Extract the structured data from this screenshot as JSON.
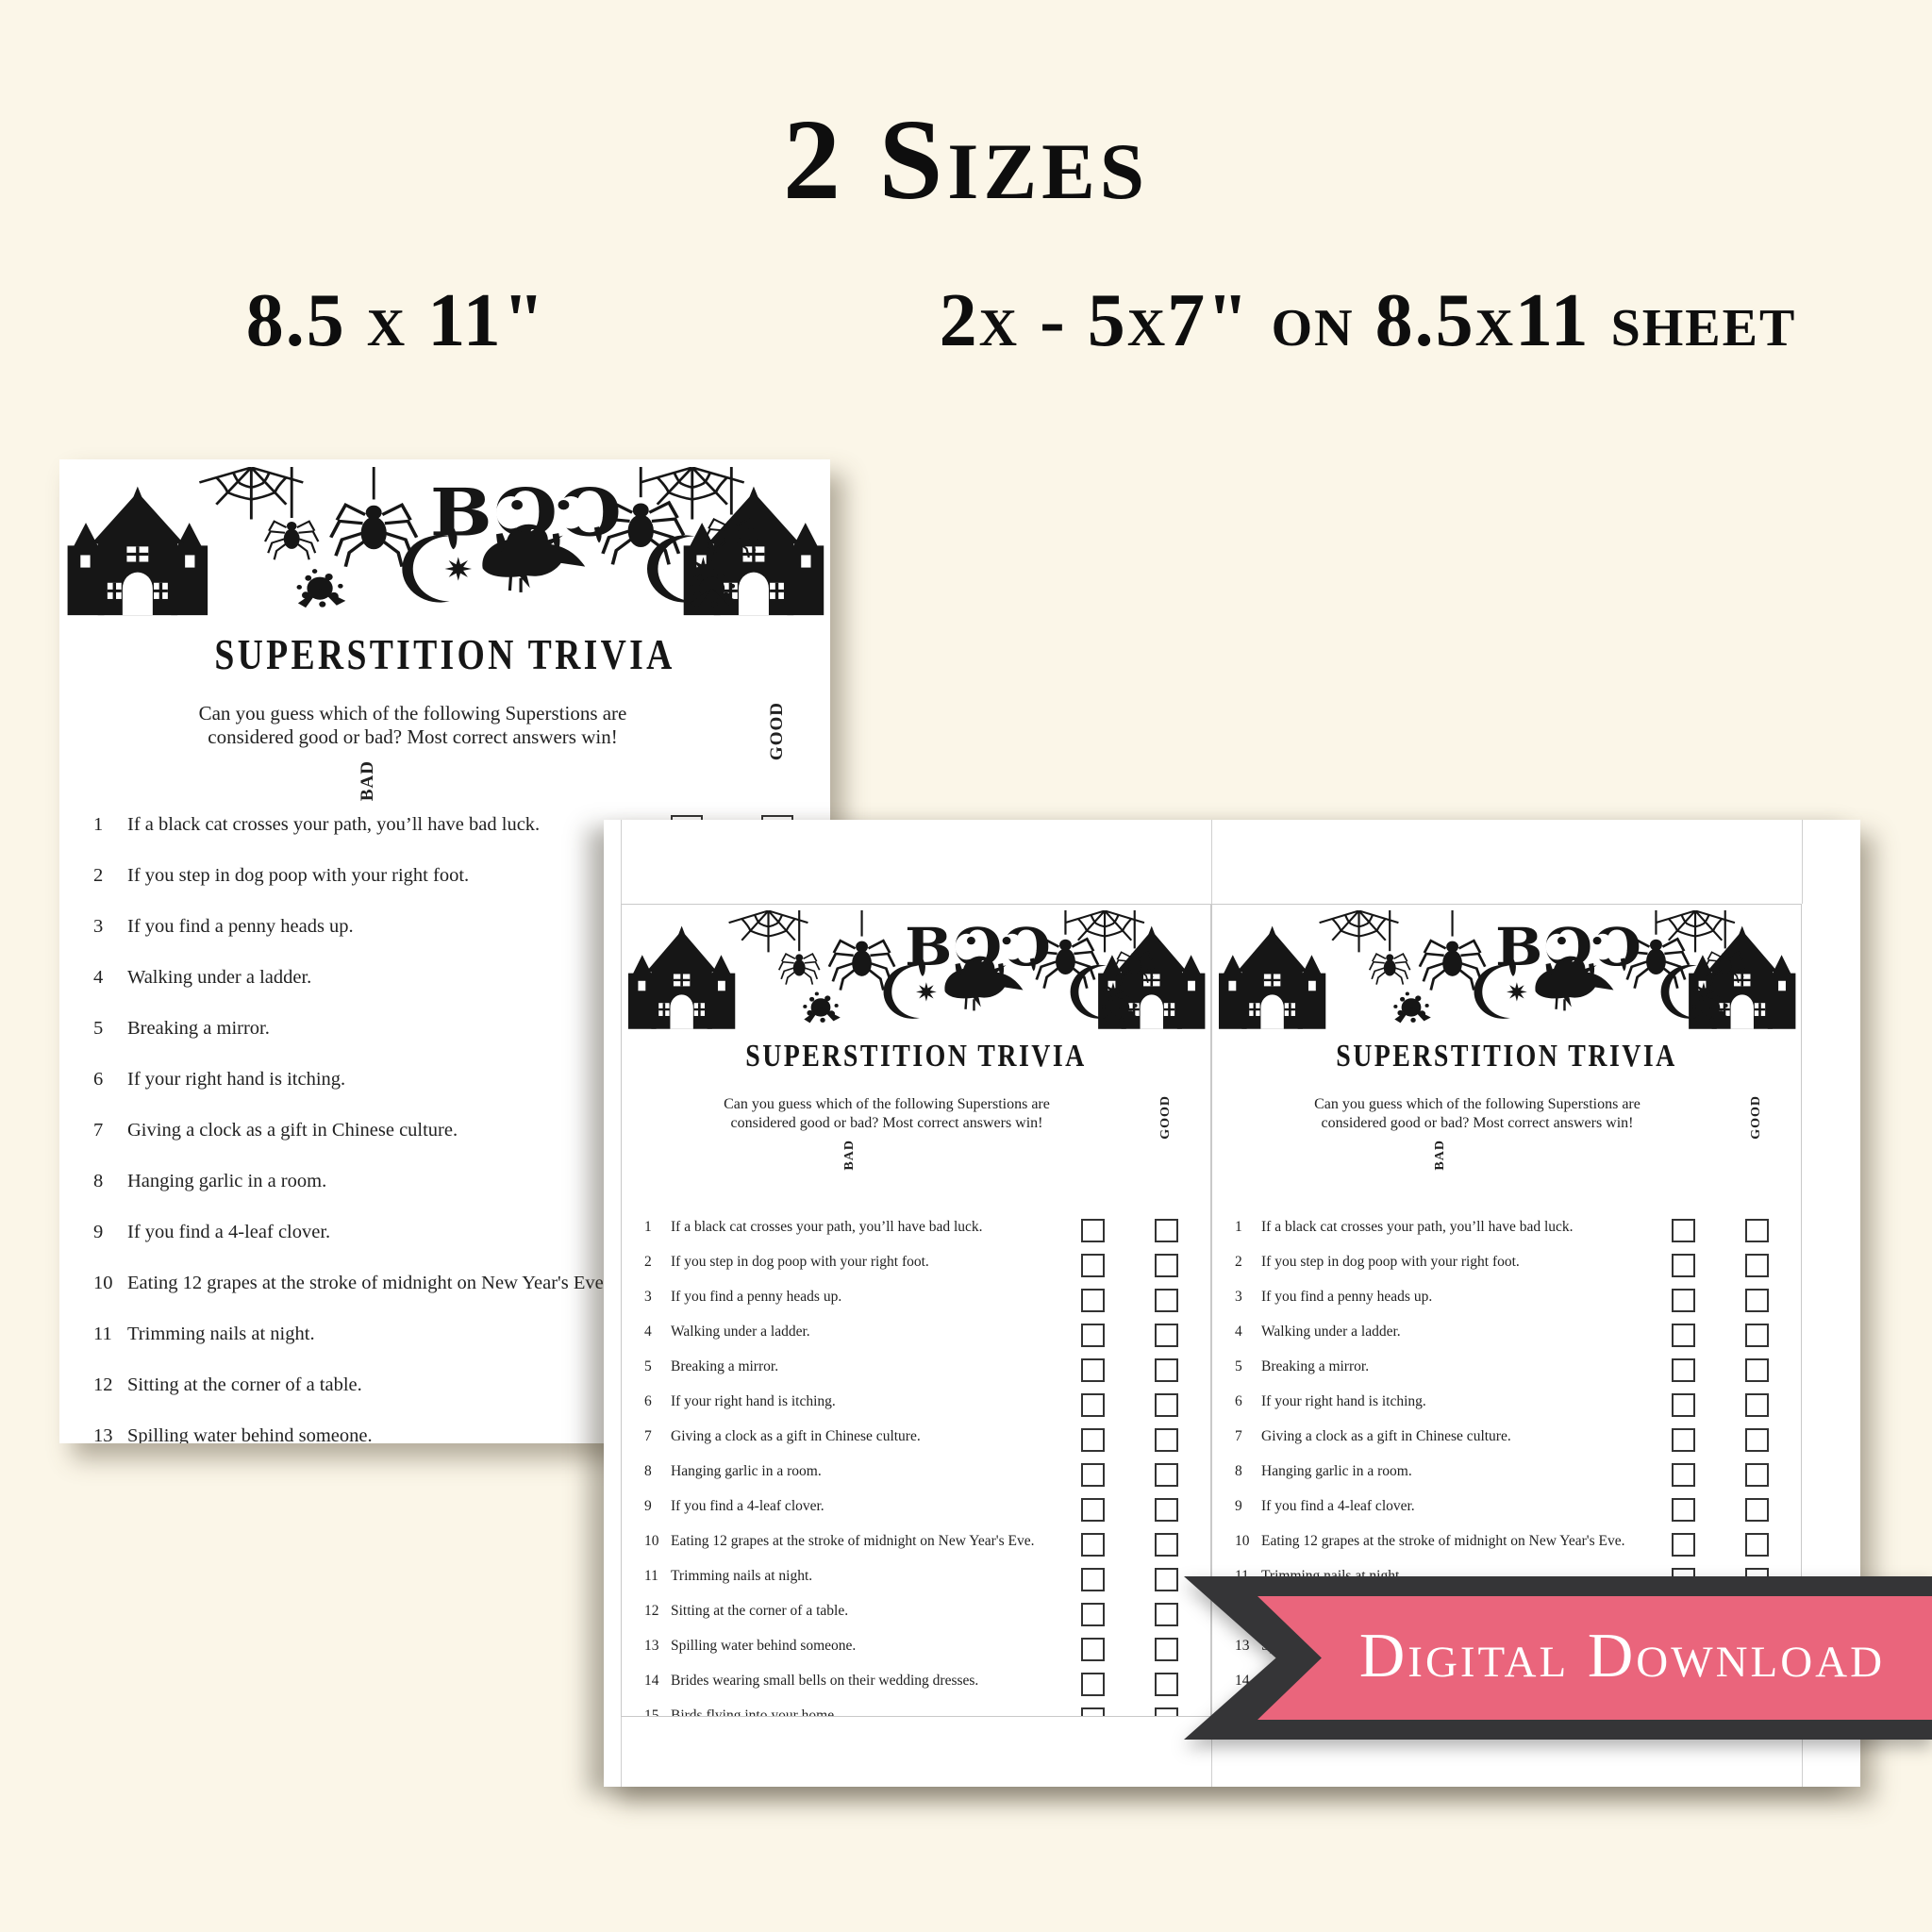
{
  "page": {
    "heading": "2 Sizes",
    "size_label_left": "8.5 x 11\"",
    "size_label_right": "2x - 5x7\" on 8.5x11 sheet",
    "background_color": "#fbf6e8"
  },
  "ribbon": {
    "label": "Digital Download",
    "pink_color": "#ea657c",
    "dark_color": "#353537"
  },
  "card": {
    "boo_text": "BOO",
    "title": "SUPERSTITION TRIVIA",
    "instructions": "Can you guess which of the following Superstions are considered good or bad? Most correct answers win!",
    "good_label": "GOOD",
    "bad_label": "BAD",
    "items": [
      "If a black cat crosses your path, you’ll have bad luck.",
      "If you step in dog poop with your right foot.",
      "If you find a penny heads up.",
      "Walking under a ladder.",
      "Breaking a mirror.",
      "If your right hand is itching.",
      "Giving a clock as a gift in Chinese culture.",
      "Hanging garlic in a room.",
      "If you find a 4-leaf clover.",
      "Eating 12 grapes at the stroke of midnight on New Year's Eve.",
      "Trimming nails at night.",
      "Sitting at the corner of a table.",
      "Spilling water behind someone.",
      "Brides wearing small bells on their wedding dresses.",
      "Birds flying into your home"
    ]
  }
}
